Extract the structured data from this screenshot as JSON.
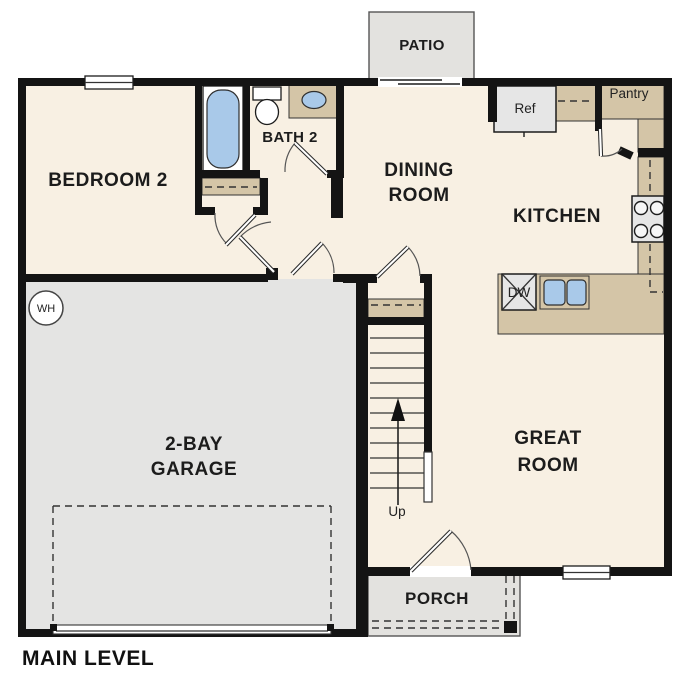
{
  "plan": {
    "title": "MAIN LEVEL",
    "level": "Main Level Floor Plan"
  },
  "colors": {
    "wall": "#141414",
    "floor": "#f8f0e3",
    "garage": "#e4e4e3",
    "outdoor": "#e3e2df",
    "cabinet": "#d4c5a7",
    "fixture_blue": "#a9c9e9",
    "appliance": "#e6e6e6"
  },
  "rooms": {
    "bedroom2": {
      "label": "BEDROOM 2"
    },
    "bath2": {
      "label": "BATH 2"
    },
    "dining": {
      "line1": "DINING",
      "line2": "ROOM"
    },
    "kitchen": {
      "label": "KITCHEN"
    },
    "great": {
      "line1": "GREAT",
      "line2": "ROOM"
    },
    "garage": {
      "line1": "2-BAY",
      "line2": "GARAGE"
    },
    "patio": {
      "label": "PATIO"
    },
    "porch": {
      "label": "PORCH"
    },
    "pantry": {
      "label": "Pantry"
    }
  },
  "fixtures": {
    "refrigerator": "Ref",
    "dishwasher": "DW",
    "water_heater": "WH",
    "stairs_direction": "Up"
  }
}
